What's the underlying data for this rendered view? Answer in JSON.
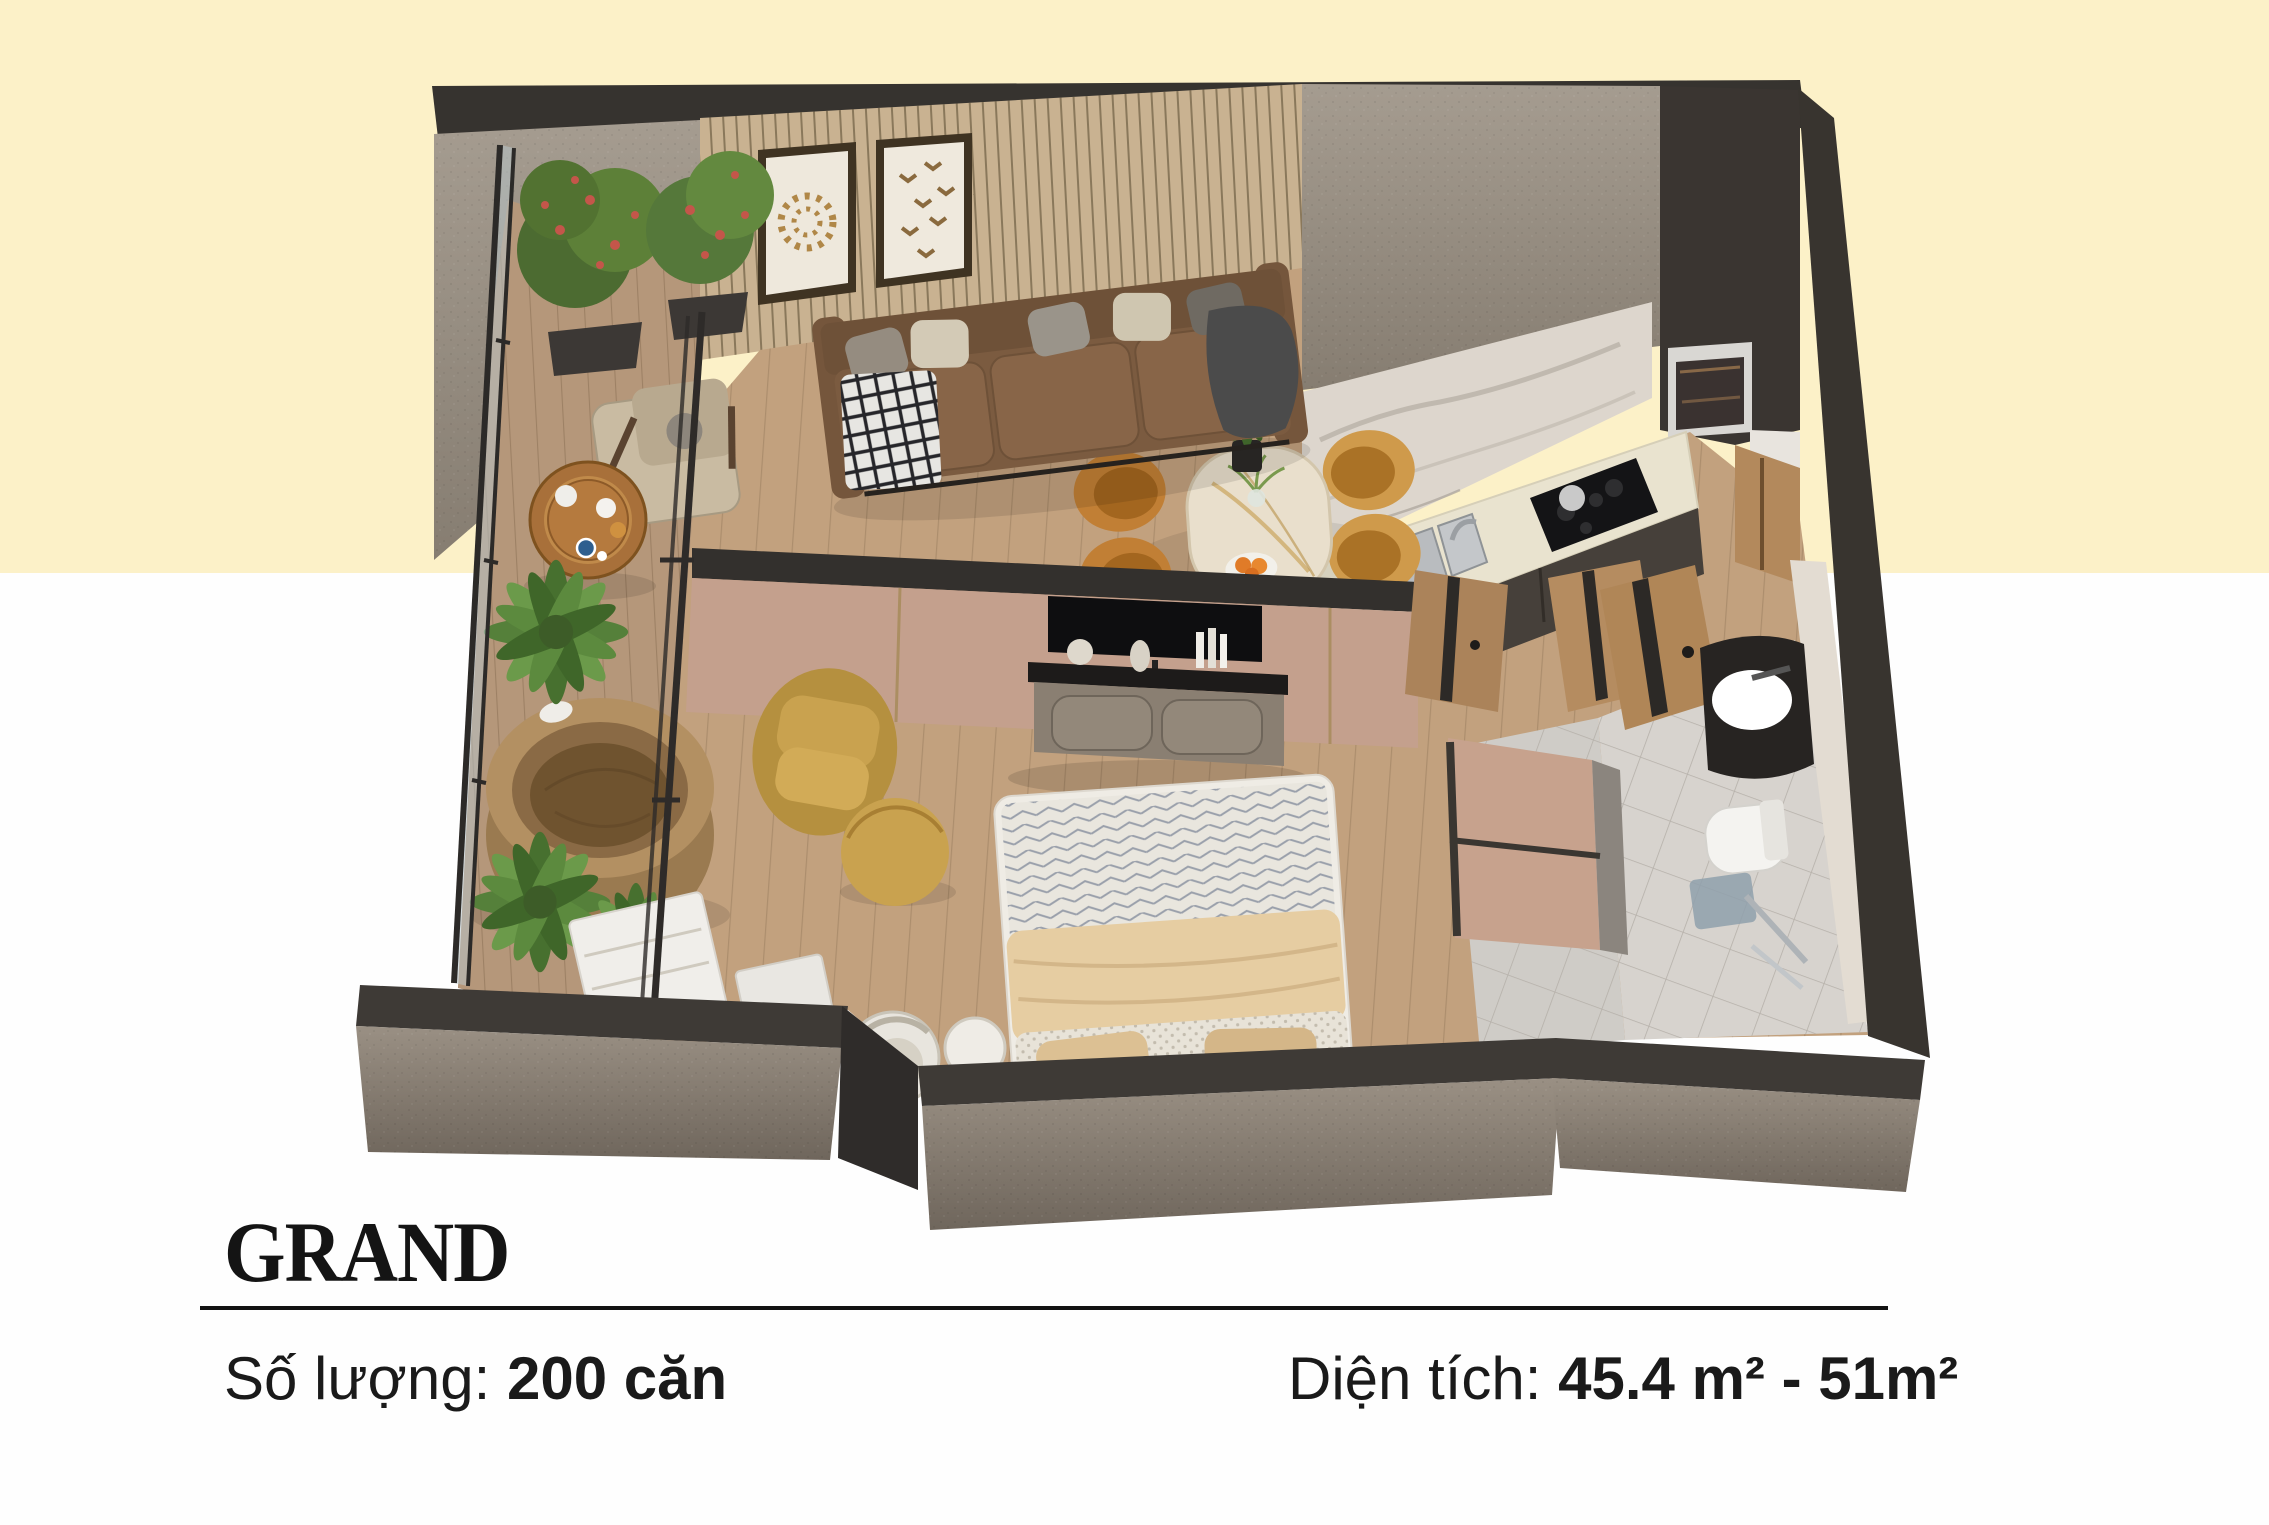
{
  "page": {
    "background_top_color": "#FCF1C8",
    "background_bottom_color": "#FEFEFE",
    "divider_color": "#121212",
    "text_color": "#1a1a1a"
  },
  "plan": {
    "title": "GRAND",
    "quantity_label": "Số lượng:",
    "quantity_value": "200 căn",
    "area_label": "Diện tích:",
    "area_value": "45.4 m² - 51m²"
  },
  "floor_plan": {
    "type": "3d-isometric-apartment-cutaway",
    "palette": {
      "wall_top": "#36332F",
      "wall_concrete": "#8E8478",
      "wood_floor": "#C2A17E",
      "slat_wall": "#C9B291",
      "counter": "#E9E3CF",
      "partition_pink": "#C4A08D",
      "sofa_brown": "#7B5B40",
      "mustard": "#C9A24F",
      "plant_green": "#55803A",
      "tile": "#D7D3CE"
    },
    "rooms": [
      "balcony",
      "living-room",
      "kitchen",
      "dining-area",
      "bedroom",
      "bathroom",
      "entrance-hall"
    ],
    "items": [
      "flower-bushes",
      "lounge-armchair",
      "breakfast-table",
      "wooden-soaking-tub",
      "palm-plants",
      "white-dresser",
      "framed-artworks",
      "sofa",
      "dining-table",
      "dining-chairs",
      "kitchen-counter",
      "sink",
      "cooktop",
      "oven",
      "tv-partition",
      "tv-console",
      "bed",
      "accent-chair",
      "ottoman",
      "desk-chair",
      "wardrobe",
      "sliding-doors",
      "bathroom-vanity",
      "toilet",
      "shower"
    ]
  }
}
